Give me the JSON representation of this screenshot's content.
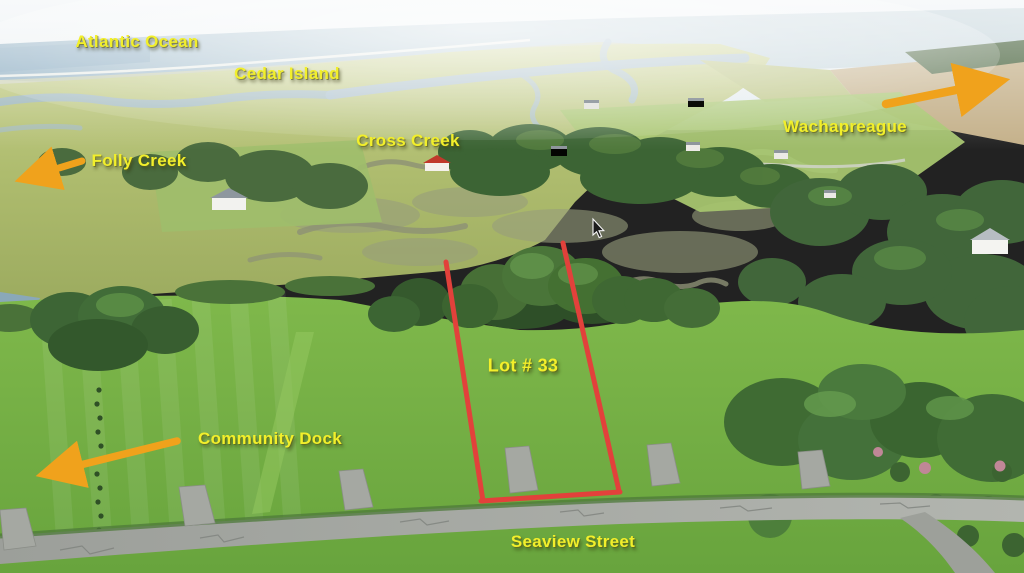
{
  "scene": {
    "type": "annotated-aerial-photo",
    "subject": "waterfront building lot with marsh, creeks and street"
  },
  "annotations": {
    "labels": {
      "atlantic_ocean": "Atlantic Ocean",
      "cedar_island": "Cedar Island",
      "cross_creek": "Cross Creek",
      "folly_creek": "Folly Creek",
      "wachapreague": "Wachapreague",
      "lot_number": "Lot # 33",
      "community_dock": "Community Dock",
      "seaview_street": "Seaview Street"
    },
    "arrows": [
      {
        "name": "folly-creek-arrow",
        "points_to": "Folly Creek",
        "direction": "down-left"
      },
      {
        "name": "community-dock-arrow",
        "points_to": "Community Dock",
        "direction": "down-left"
      },
      {
        "name": "wachapreague-arrow",
        "points_to": "Wachapreague",
        "direction": "up-right"
      }
    ],
    "colors": {
      "label_text": "#f2ef2b",
      "arrow": "#f0a21c",
      "lot_outline": "#e2413b"
    }
  },
  "cursor": {
    "style": "arrow",
    "position": "over marsh left of lot"
  }
}
